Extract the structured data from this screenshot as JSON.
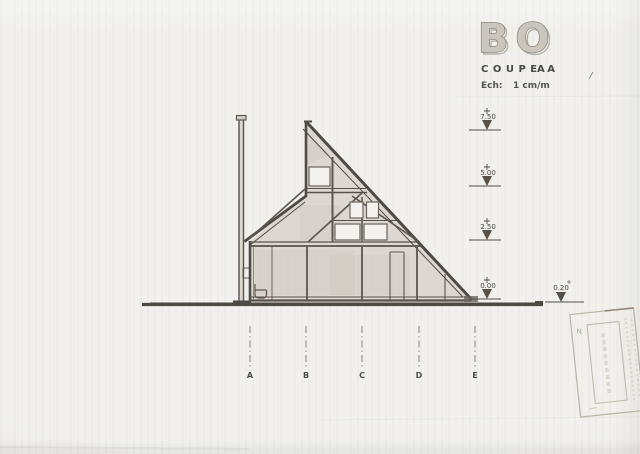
{
  "logo": {
    "text": "BO"
  },
  "title_block": {
    "title": "COUPE",
    "section_ref": "AA",
    "scale_label": "Ech:",
    "scale_value": "1 cm/m"
  },
  "elevation_markers": {
    "levels": [
      {
        "label": "7.50"
      },
      {
        "label": "5.00"
      },
      {
        "label": "2.50"
      },
      {
        "label": "0.00"
      }
    ],
    "offset_marker": {
      "label": "0.20"
    }
  },
  "grid": {
    "labels": [
      "A",
      "B",
      "C",
      "D",
      "E"
    ]
  },
  "stamp": {
    "mark": "N"
  },
  "colors": {
    "paper": "#eeede9",
    "line": "#57514a",
    "shading": "#d8d4cb",
    "text": "#4c4a46",
    "logo_fill": "#cbc6bd",
    "logo_stroke": "#8d877c",
    "stamp": "#bcb5a8"
  }
}
